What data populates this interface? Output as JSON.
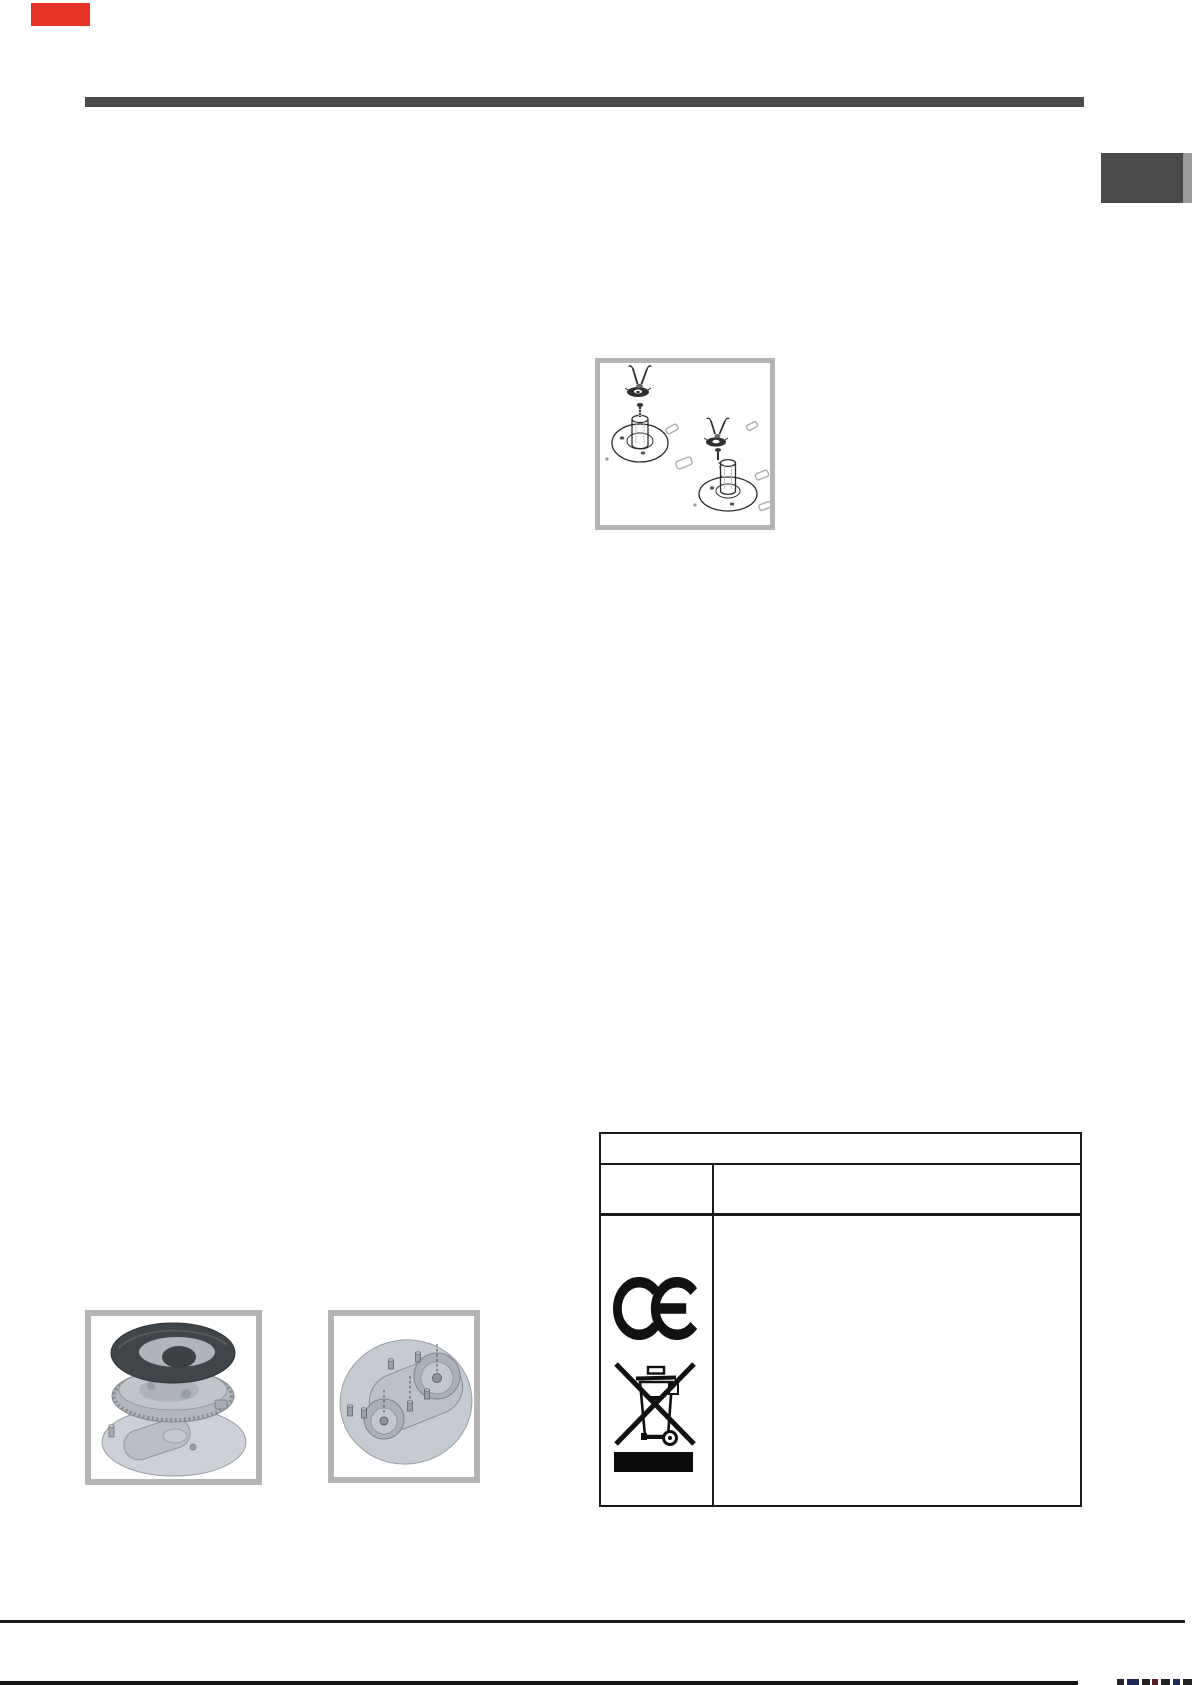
{
  "page": {
    "kind": "scanned appliance manual page",
    "background": "#ffffff",
    "width_px": 1192,
    "height_px": 1685
  },
  "colors": {
    "red_marker": "#e53427",
    "top_rule": "#4a4a4a",
    "side_tab": "#4a4a4a",
    "side_tab_edge": "#9b9b9b",
    "figure_frame": "#b4b4b4",
    "table_border": "#1a1a1a",
    "symbol_ink": "#111111",
    "footer_rule": "#1b1b1b",
    "burner_dark_ring": "#40454a",
    "burner_metal_light": "#cdd1d7",
    "burner_metal_mid": "#b3b8bf"
  },
  "figures": {
    "screw_installation": {
      "icon": "screwdriver-burner-cup-installation-diagram",
      "caption": ""
    },
    "burner_exploded": {
      "icon": "burner-exploded-view-diagram",
      "caption": ""
    },
    "burner_base": {
      "icon": "burner-base-plate-diagram",
      "caption": ""
    }
  },
  "table": {
    "title_row_text": "",
    "header_cells": [
      "",
      ""
    ],
    "body": {
      "left_cell_symbols": [
        "ce-mark",
        "weee-crossed-out-wheelie-bin-icon",
        "weee-black-bar"
      ],
      "right_cell_text": ""
    }
  },
  "footer": {
    "separator_rule": true,
    "bottom_edge_rule": true,
    "cutoff_print_fragments": true
  }
}
